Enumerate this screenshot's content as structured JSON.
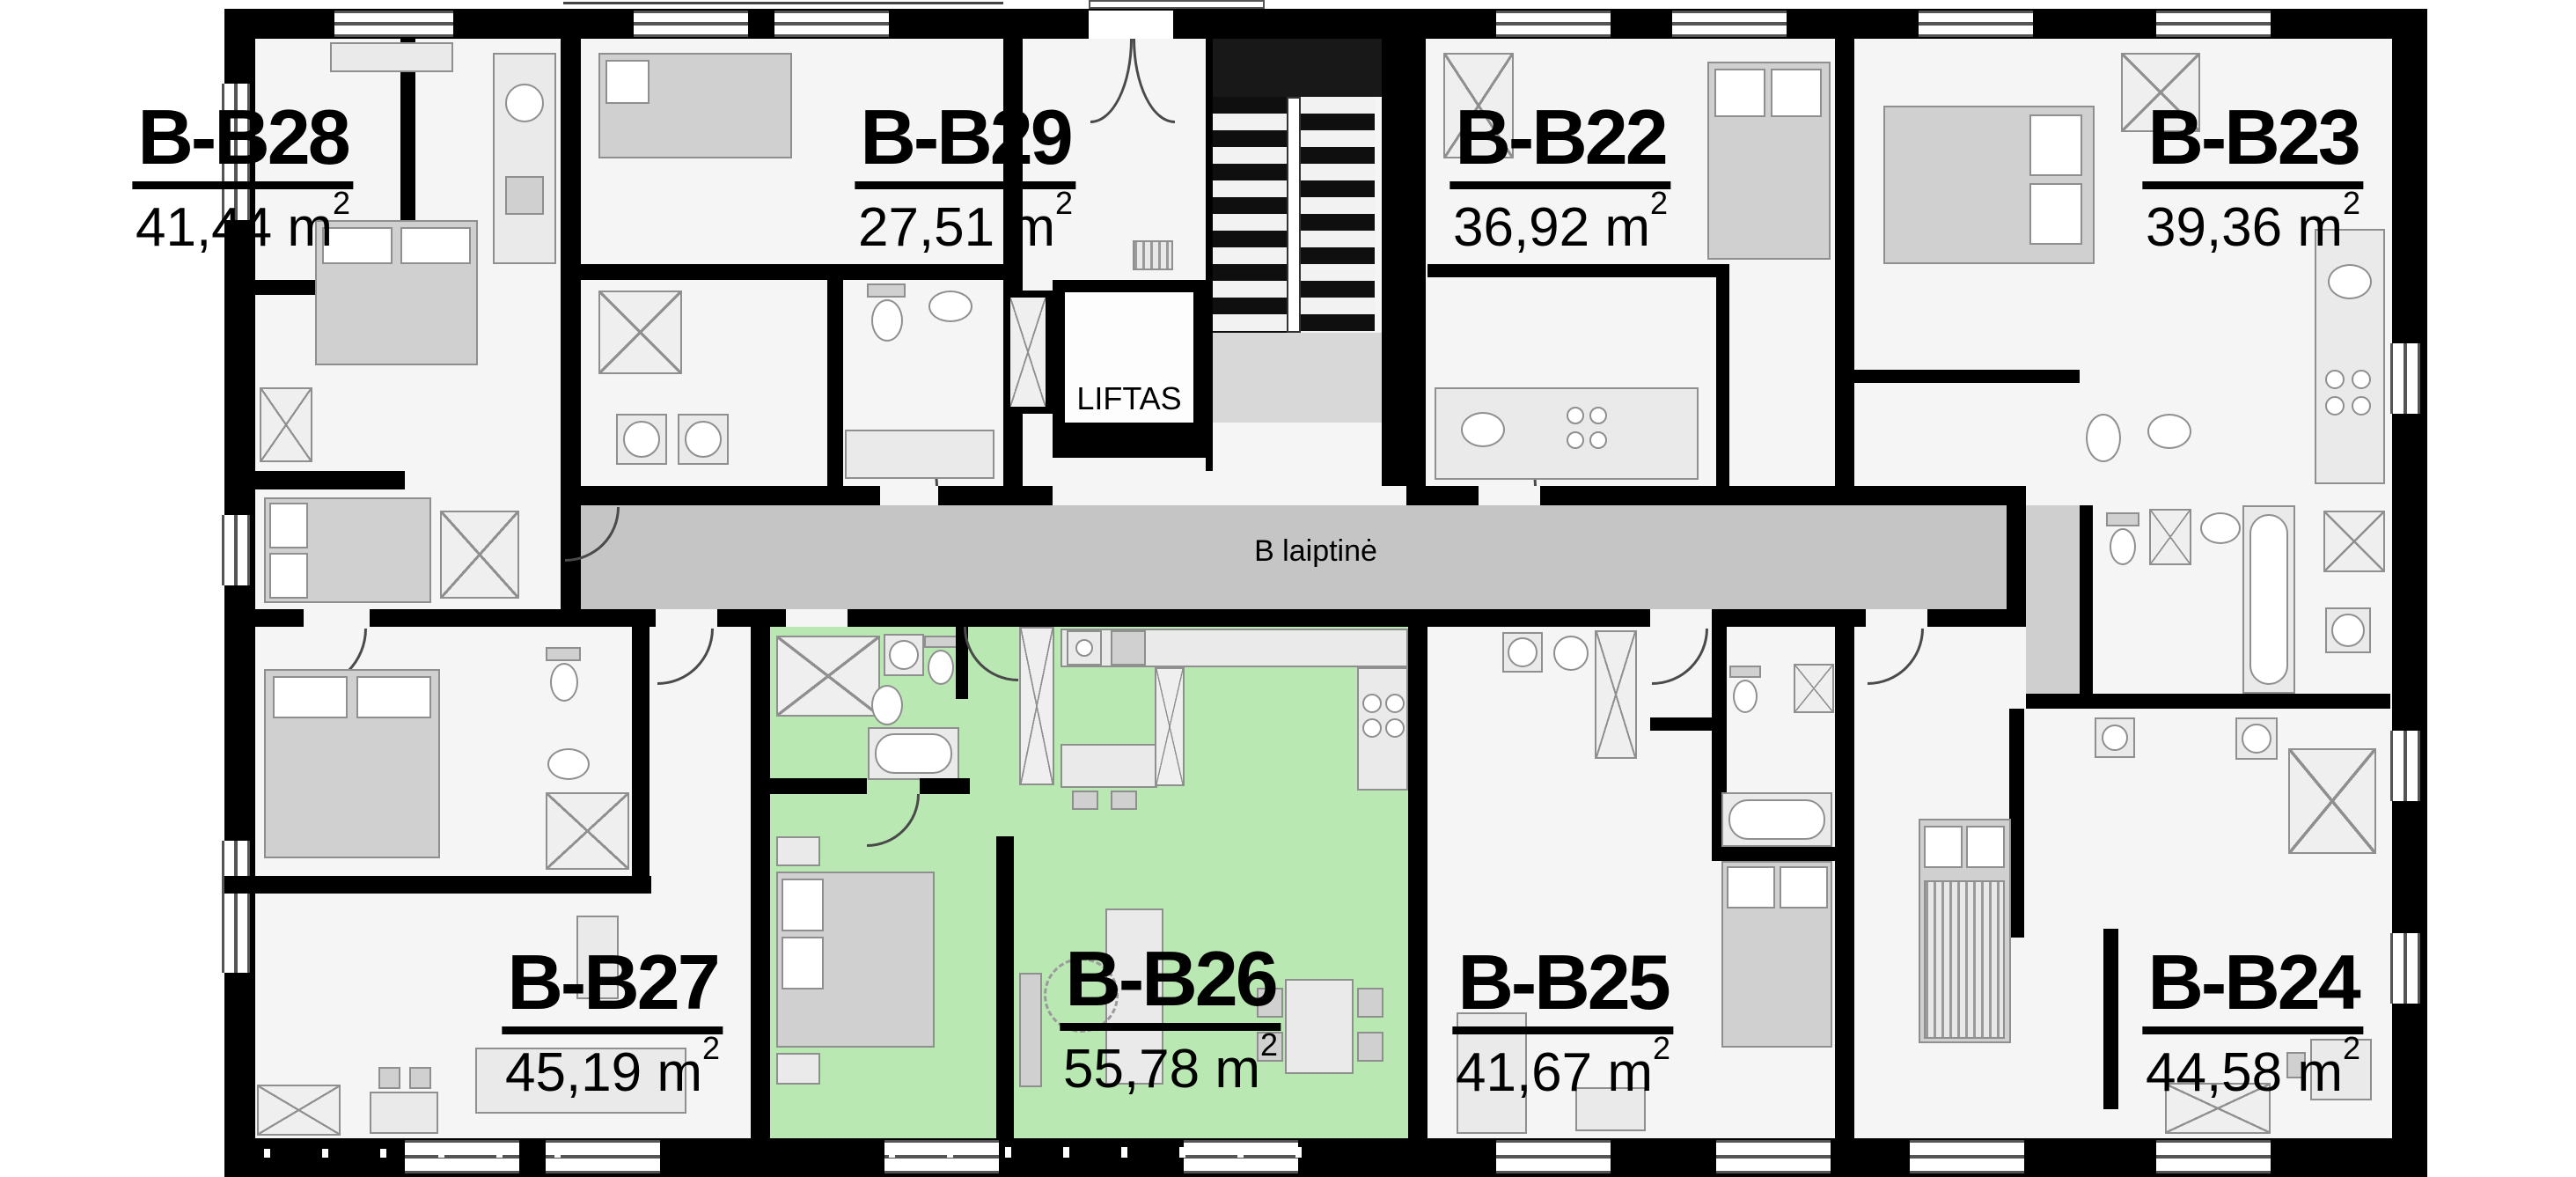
{
  "labels": {
    "unit": "m",
    "unit_sup": "2"
  },
  "core": {
    "elevator_label": "LIFTAS",
    "staircase_label": "B laiptinė"
  },
  "colors": {
    "highlight_green": "#b9e8b2",
    "wall_black": "#000000",
    "corridor_gray": "#c5c5c5"
  },
  "apartments": [
    {
      "id": "B-B28",
      "area_value": "41,44",
      "highlighted": false
    },
    {
      "id": "B-B29",
      "area_value": "27,51",
      "highlighted": false
    },
    {
      "id": "B-B22",
      "area_value": "36,92",
      "highlighted": false
    },
    {
      "id": "B-B23",
      "area_value": "39,36",
      "highlighted": false
    },
    {
      "id": "B-B27",
      "area_value": "45,19",
      "highlighted": false
    },
    {
      "id": "B-B26",
      "area_value": "55,78",
      "highlighted": true
    },
    {
      "id": "B-B25",
      "area_value": "41,67",
      "highlighted": false
    },
    {
      "id": "B-B24",
      "area_value": "44,58",
      "highlighted": false
    }
  ]
}
